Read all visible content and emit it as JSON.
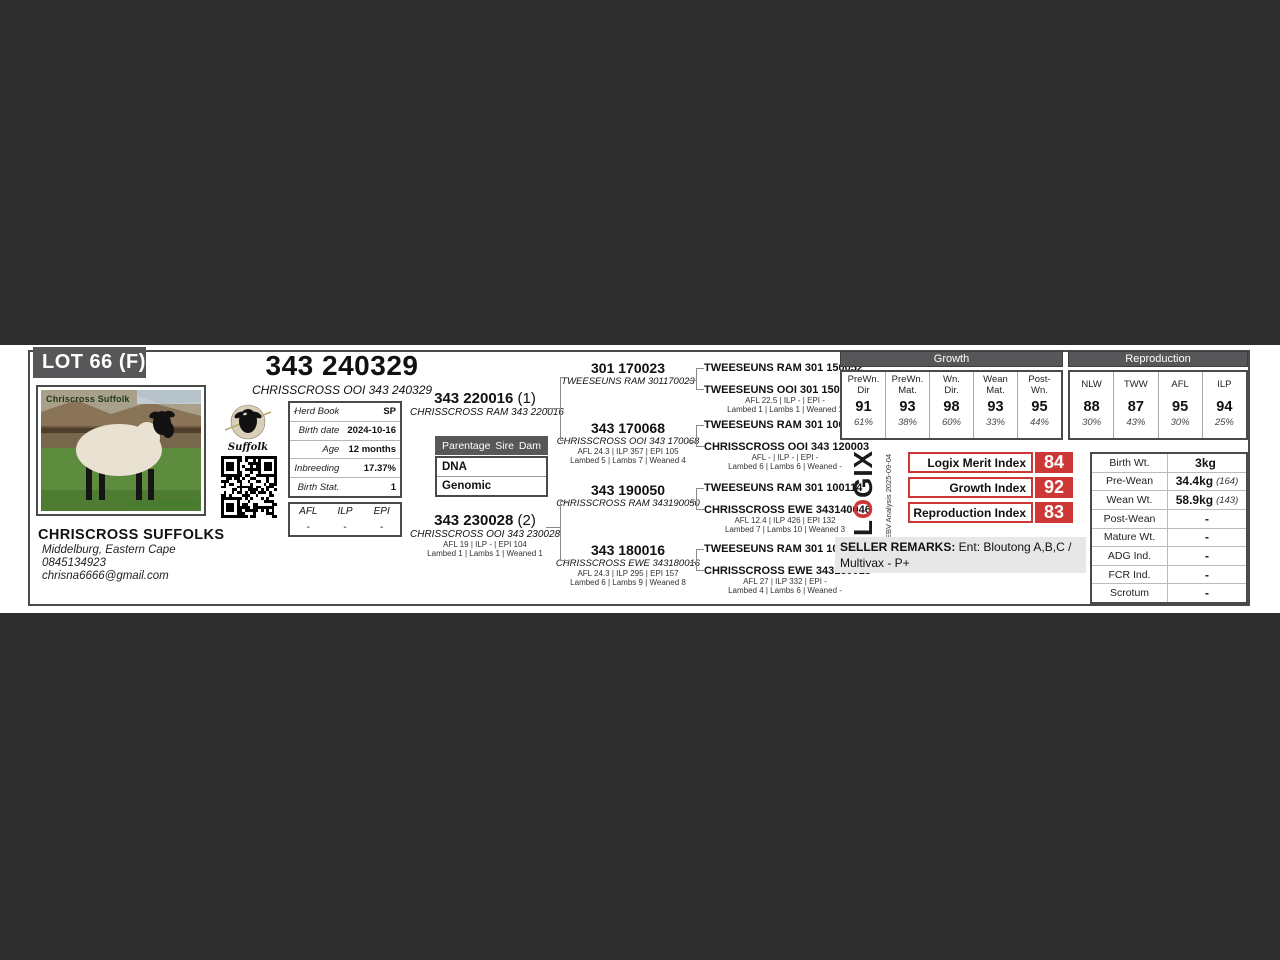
{
  "lot": {
    "label": "LOT 66 (F)"
  },
  "title": {
    "id": "343 240329",
    "name": "CHRISSCROSS OOI 343 240329"
  },
  "photo": {
    "watermark": "Chriscross Suffolk",
    "caption": "LOT 66 343240329"
  },
  "breeder": {
    "name": "CHRISCROSS SUFFOLKS",
    "location": "Middelburg, Eastern Cape",
    "phone": "0845134923",
    "email": "chrisna6666@gmail.com"
  },
  "breed_logo": {
    "label": "Suffolk"
  },
  "info_table": {
    "marker": ".",
    "rows": [
      {
        "label": "Herd Book",
        "value": "SP"
      },
      {
        "label": "Birth date",
        "value": "2024-10-16"
      },
      {
        "label": "Age",
        "value": "12 months"
      },
      {
        "label": "Inbreeding",
        "value": "17.37%"
      },
      {
        "label": "Birth Stat.",
        "value": "1"
      }
    ]
  },
  "afl_table": {
    "headers": [
      "AFL",
      "ILP",
      "EPI"
    ],
    "values": [
      "-",
      "-",
      "-"
    ]
  },
  "parentage": {
    "title": "Parentage",
    "col_sire": "Sire",
    "col_dam": "Dam",
    "rows": [
      "DNA",
      "Genomic"
    ]
  },
  "pedigree": {
    "sire": {
      "id": "343 220016",
      "tag": "(1)",
      "name": "CHRISSCROSS RAM 343 220016"
    },
    "dam": {
      "id": "343 230028",
      "tag": "(2)",
      "name": "CHRISSCROSS OOI 343 230028",
      "stats1": "AFL 19 | ILP - | EPI 104",
      "stats2": "Lambed 1 | Lambs 1 | Weaned 1"
    },
    "gen2": [
      {
        "id": "301 170023",
        "name": "TWEESEUNS RAM 301170023",
        "stats1": "",
        "stats2": ""
      },
      {
        "id": "343 170068",
        "name": "CHRISSCROSS OOI 343 170068",
        "stats1": "AFL 24.3 | ILP 357 | EPI 105",
        "stats2": "Lambed 5 | Lambs 7 | Weaned 4"
      },
      {
        "id": "343 190050",
        "name": "CHRISSCROSS RAM 343190050",
        "stats1": "",
        "stats2": ""
      },
      {
        "id": "343 180016",
        "name": "CHRISSCROSS EWE 343180016",
        "stats1": "AFL 24.3 | ILP 295 | EPI 157",
        "stats2": "Lambed 6 | Lambs 9 | Weaned 8"
      }
    ],
    "gen3": [
      {
        "name": "TWEESEUNS RAM 301 150052",
        "stats1": "",
        "stats2": ""
      },
      {
        "name": "TWEESEUNS OOI 301 150172",
        "stats1": "AFL 22.5 | ILP - | EPI -",
        "stats2": "Lambed 1 | Lambs 1 | Weaned 1"
      },
      {
        "name": "TWEESEUNS RAM 301 100174",
        "stats1": "",
        "stats2": ""
      },
      {
        "name": "CHRISSCROSS OOI 343 120003",
        "stats1": "AFL - | ILP - | EPI -",
        "stats2": "Lambed 6 | Lambs 6 | Weaned -"
      },
      {
        "name": "TWEESEUNS RAM 301 100114",
        "stats1": "",
        "stats2": ""
      },
      {
        "name": "CHRISSCROSS EWE 343140046",
        "stats1": "AFL 12.4 | ILP 426 | EPI 132",
        "stats2": "Lambed 7 | Lambs 10 | Weaned 3"
      },
      {
        "name": "TWEESEUNS RAM 301 100174",
        "stats1": "",
        "stats2": ""
      },
      {
        "name": "CHRISSCROSS EWE 343130018",
        "stats1": "AFL 27 | ILP 332 | EPI -",
        "stats2": "Lambed 4 | Lambs 6 | Weaned -"
      }
    ]
  },
  "growth": {
    "title": "Growth",
    "columns": [
      {
        "header": "PreWn.\nDir",
        "value": "91",
        "accuracy": "61%"
      },
      {
        "header": "PreWn.\nMat.",
        "value": "93",
        "accuracy": "38%"
      },
      {
        "header": "Wn.\nDir.",
        "value": "98",
        "accuracy": "60%"
      },
      {
        "header": "Wean\nMat.",
        "value": "93",
        "accuracy": "33%"
      },
      {
        "header": "Post-\nWn.",
        "value": "95",
        "accuracy": "44%"
      }
    ]
  },
  "reproduction": {
    "title": "Reproduction",
    "columns": [
      {
        "header": "NLW",
        "value": "88",
        "accuracy": "30%"
      },
      {
        "header": "TWW",
        "value": "87",
        "accuracy": "43%"
      },
      {
        "header": "AFL",
        "value": "95",
        "accuracy": "30%"
      },
      {
        "header": "ILP",
        "value": "94",
        "accuracy": "25%"
      }
    ]
  },
  "logix": {
    "brand_l": "L",
    "brand_o": "O",
    "brand_rest": "GIX",
    "analysis": "EBV Analysis 2025-09-04"
  },
  "indices": [
    {
      "label": "Logix Merit Index",
      "value": "84"
    },
    {
      "label": "Growth Index",
      "value": "92"
    },
    {
      "label": "Reproduction Index",
      "value": "83"
    }
  ],
  "seller_remarks": {
    "label": "SELLER REMARKS:",
    "text": " Ent: Bloutong A,B,C / Multivax - P+"
  },
  "weights": {
    "rows": [
      {
        "label": "Birth Wt.",
        "value": "3kg",
        "note": ""
      },
      {
        "label": "Pre-Wean",
        "value": "34.4kg",
        "note": "(164)"
      },
      {
        "label": "Wean Wt.",
        "value": "58.9kg",
        "note": "(143)"
      },
      {
        "label": "Post-Wean",
        "value": "-",
        "note": ""
      },
      {
        "label": "Mature Wt.",
        "value": "-",
        "note": ""
      },
      {
        "label": "ADG Ind.",
        "value": "-",
        "note": ""
      },
      {
        "label": "FCR Ind.",
        "value": "-",
        "note": ""
      },
      {
        "label": "Scrotum",
        "value": "-",
        "note": ""
      }
    ]
  },
  "colors": {
    "accent_red": "#cd3836",
    "band_dark": "#2d2d2d",
    "header_gray": "#57575a"
  }
}
